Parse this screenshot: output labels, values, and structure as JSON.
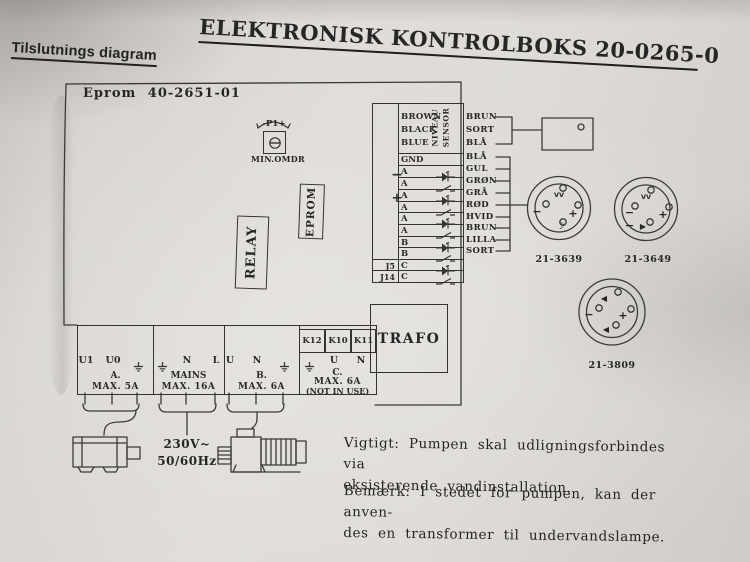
{
  "page": {
    "title": "ELEKTRONISK KONTROLBOKS 20-0265-0",
    "subtitle": "Tilslutnings diagram"
  },
  "board": {
    "eprom_version_label": "Eprom 40-2651-01",
    "trimmer": {
      "label": "-P1+",
      "caption": "MIN.OMDR"
    },
    "relay_label": "RELAY",
    "eprom_chip_label": "EPROM",
    "trafo_label": "TRAFO"
  },
  "sensor_block": {
    "vertical_label_1": "NIVEAU",
    "vertical_label_2": "SENSOR",
    "input_wires": [
      "BROWN",
      "BLACK",
      "BLUE"
    ],
    "output_wires": [
      "BRUN",
      "SORT",
      "BLÅ"
    ],
    "gnd_label": "GND",
    "gnd_wire": "BLÅ",
    "rows": [
      {
        "pin": "A",
        "sign": "−",
        "symbol": "led-diode-icon",
        "wire": "GUL"
      },
      {
        "pin": "A",
        "symbol": "switch-icon",
        "wire": "GRØN"
      },
      {
        "pin": "A",
        "sign": "+",
        "symbol": "led-diode-icon",
        "wire": "GRÅ"
      },
      {
        "pin": "A",
        "symbol": "switch-icon",
        "wire": "RØD"
      },
      {
        "pin": "A",
        "symbol": "led-diode-icon",
        "wire": "HVID"
      },
      {
        "pin": "A",
        "symbol": "switch-icon",
        "wire": "BRUN"
      },
      {
        "pin": "B",
        "symbol": "led-diode-icon",
        "wire": "LILLA"
      },
      {
        "pin": "B",
        "symbol": "switch-icon",
        "wire": "SORT"
      },
      {
        "pin": "C",
        "jumper": "J5",
        "symbol": "led-diode-icon"
      },
      {
        "pin": "C",
        "jumper": "J14",
        "symbol": "switch-icon"
      }
    ]
  },
  "k_boxes": [
    "K12",
    "K10",
    "K11"
  ],
  "terminal_strip": {
    "sections": [
      {
        "terminals": [
          "U1",
          "U0",
          "earth-icon"
        ],
        "name": "A.",
        "rating": "MAX. 5A"
      },
      {
        "terminals": [
          "earth-icon",
          "N",
          "L"
        ],
        "name": "MAINS",
        "rating": "MAX. 16A"
      },
      {
        "terminals": [
          "U",
          "N",
          "earth-icon"
        ],
        "name": "B.",
        "rating": "MAX. 6A"
      },
      {
        "terminals": [
          "earth-icon",
          "U",
          "N"
        ],
        "name": "C.",
        "rating": "MAX. 6A",
        "note": "(NOT IN USE)"
      }
    ]
  },
  "connectors": [
    {
      "id": "21-3639",
      "top_symbol": "VV",
      "left_symbol": "−",
      "right_symbol": "+",
      "bottom_symbol": "☽"
    },
    {
      "id": "21-3649",
      "top_symbol": "VV",
      "left_symbol": "− −",
      "right_symbol": "+",
      "bottom_symbol": "▶"
    },
    {
      "id": "21-3809",
      "top_symbol": "◀",
      "left_symbol": "−",
      "right_symbol": "+",
      "bottom_symbol": "◀"
    }
  ],
  "power": {
    "voltage": "230V~",
    "frequency": "50/60Hz"
  },
  "notes": {
    "important_line1": "Vigtigt: Pumpen skal udligningsforbindes via",
    "important_line2": "eksisterende vandinstallation.",
    "remark_line1": "Bemærk: I stedet for pumpen, kan der anven-",
    "remark_line2": "des en transformer til undervandslampe."
  }
}
